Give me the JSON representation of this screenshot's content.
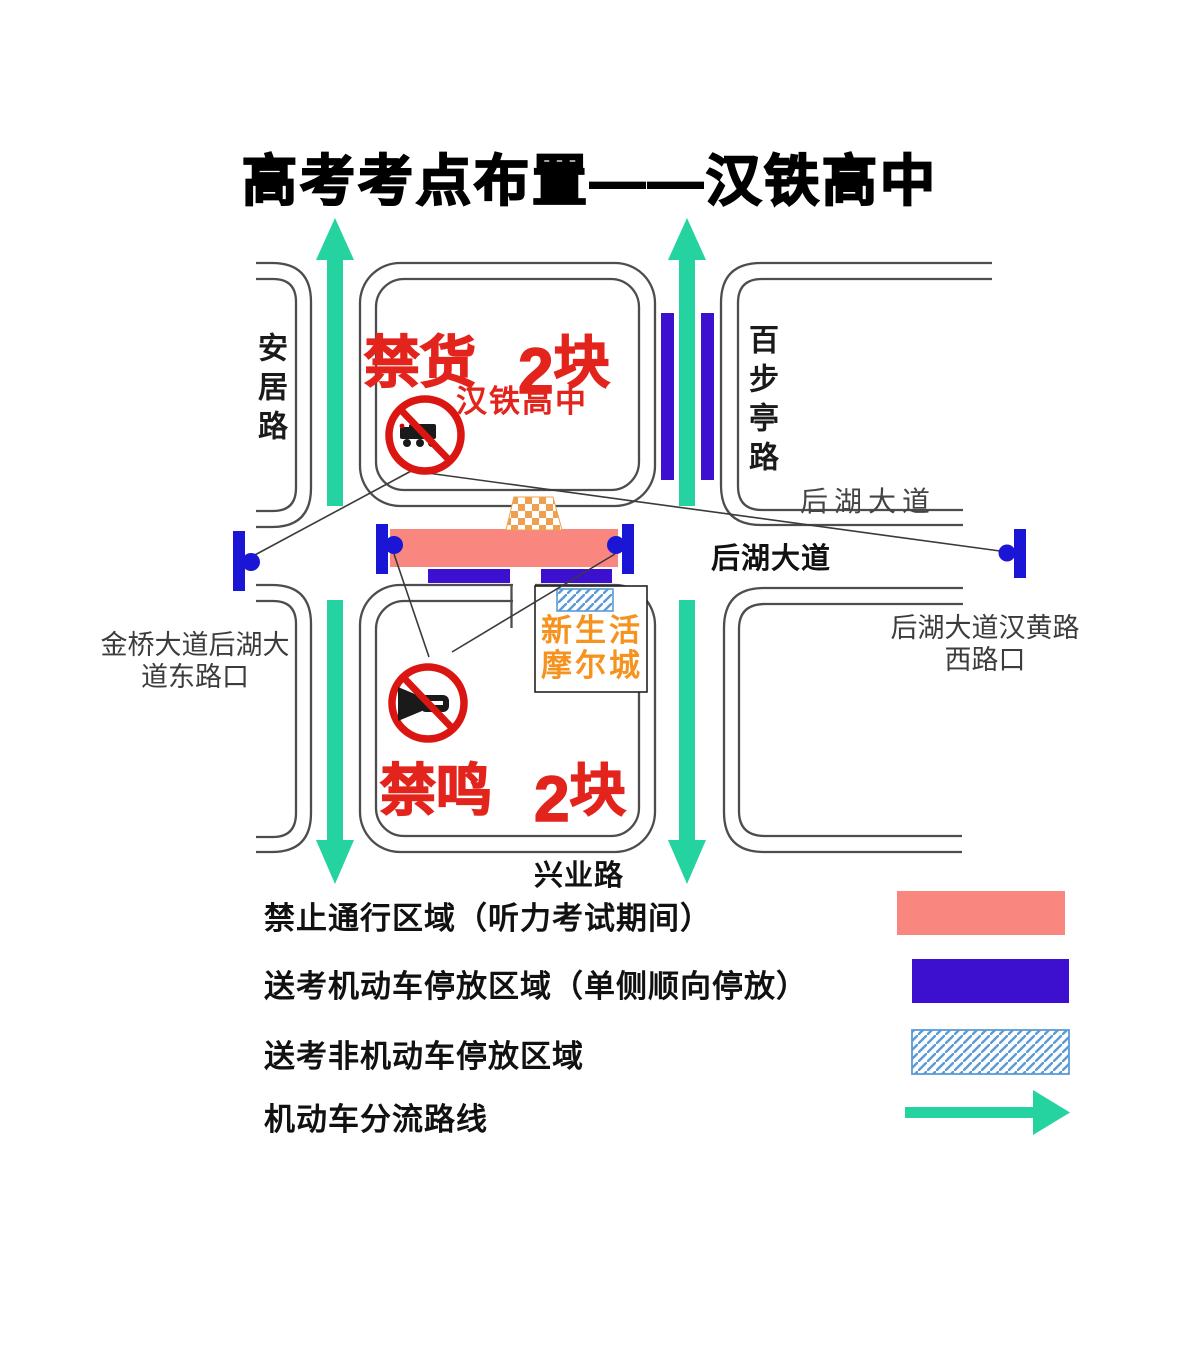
{
  "title": "高考考点布置——汉铁高中",
  "map": {
    "school_name": "汉铁高中",
    "no_truck": {
      "label": "禁货",
      "qty_num": "2",
      "qty_unit": "块"
    },
    "no_horn": {
      "label": "禁鸣",
      "qty_num": "2",
      "qty_unit": "块"
    },
    "mall": {
      "line1": "新生活",
      "line2": "摩尔城"
    },
    "roads": {
      "anju": "安居路",
      "baibuting": "百步亭路",
      "houhu_block": "后湖大道",
      "houhu_road": "后湖大道",
      "xingye": "兴业路"
    },
    "intersections": {
      "jinqiao_line1": "金桥大道后湖大",
      "jinqiao_line2": "道东路口",
      "hanhuang_line1": "后湖大道汉黄路",
      "hanhuang_line2": "西路口"
    }
  },
  "legend": {
    "items": [
      {
        "label": "禁止通行区域（听力考试期间）",
        "swatch": "pink-closed-area"
      },
      {
        "label": "送考机动车停放区域（单侧顺向停放）",
        "swatch": "blue-parking-area"
      },
      {
        "label": "送考非机动车停放区域",
        "swatch": "hatched-nonmotor-area"
      },
      {
        "label": "机动车分流路线",
        "swatch": "green-flow-arrow"
      }
    ]
  },
  "colors": {
    "closed_area_pink": "#F9867F",
    "parking_blue": "#3C10CE",
    "barrier_blue": "#1B16D6",
    "flow_arrow_green": "#25D3A0",
    "hatch_line_blue": "#5B9BD5",
    "sign_ring_red": "#DA1512",
    "text_red": "#E3241D",
    "mall_orange": "#F6921E",
    "gate_checker_orange": "#EDA04E",
    "road_line_gray": "#4D4D4D"
  }
}
